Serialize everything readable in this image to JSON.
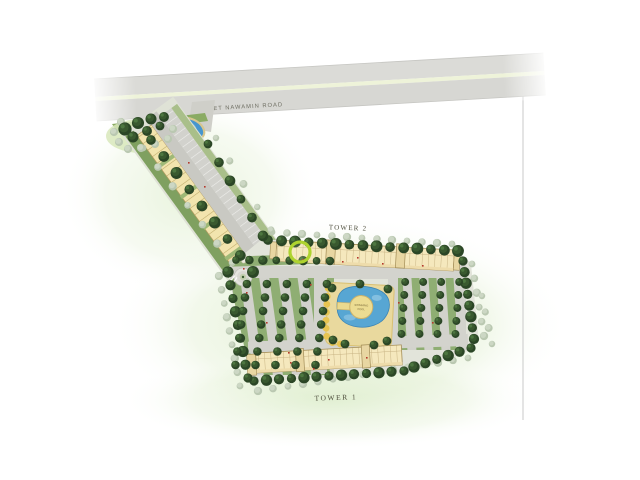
{
  "road": {
    "label": "KASET NAWAMIN ROAD"
  },
  "buildings": {
    "tower2_label": "TOWER 2",
    "tower1_label": "TOWER 1"
  },
  "pool": {
    "island_line1": "SWIMMING",
    "island_line2": "POOL"
  },
  "marker": {
    "color": "#aed32f"
  },
  "colors": {
    "road": "#d8d8d4",
    "road_median": "#eef3d9",
    "ground": "#e2e4da",
    "building": "#f5e8bd",
    "building_outline": "#a38d57",
    "water": "#57a6d3",
    "pool_deck": "#e9d99e",
    "tree_dark": "#2b4626",
    "tree_light": "#b8c6af",
    "lawn_glow": "#dcedcb",
    "label_text": "#50503f"
  }
}
